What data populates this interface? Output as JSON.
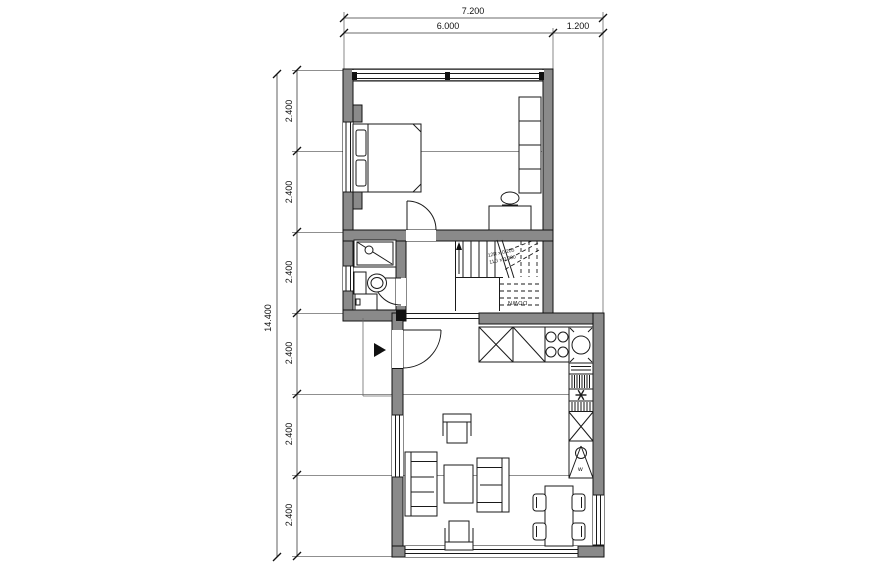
{
  "drawing_type": "floor-plan",
  "dims": {
    "top_overall": "7.200",
    "top_segments": [
      "6.000",
      "1.200"
    ],
    "left_overall": "14.400",
    "left_segments": [
      "2.400",
      "2.400",
      "2.400",
      "2.400",
      "2.400",
      "2.400"
    ]
  },
  "stairs": {
    "note1": "12R x 0.205",
    "note2": "11G x 0.300",
    "down": "DOWN"
  },
  "kitchen": {
    "washer_label": "w"
  },
  "colors": {
    "background": "#ffffff",
    "wall_fill": "#8a8a8a",
    "outline": "#111111",
    "furniture_line": "#1a1a1a",
    "dim_line": "#3a3a3a",
    "grid_line": "#6a6a6a"
  }
}
